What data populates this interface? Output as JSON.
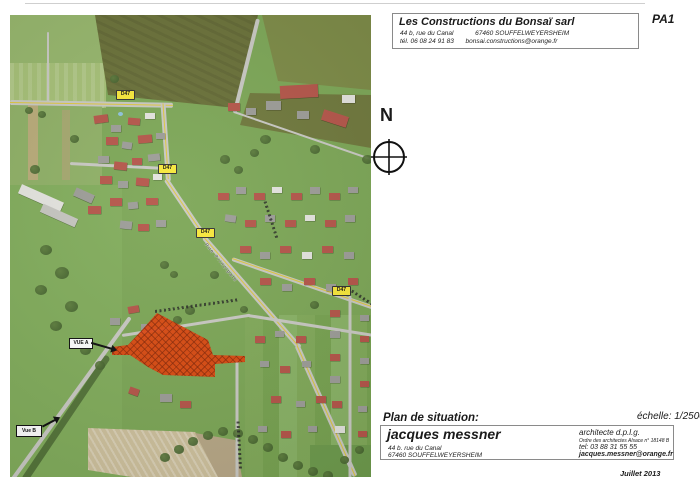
{
  "header": {
    "company_name": "Les Constructions du Bonsaï sarl",
    "company_address": "44 b, rue du Canal",
    "company_city": "67460 SOUFFELWEYERSHEIM",
    "company_phone": "tél. 06 08 24 91 83",
    "company_email": "bonsai.constructions@orange.fr",
    "doc_code": "PA1"
  },
  "compass": {
    "north_label": "N"
  },
  "map": {
    "badges": [
      {
        "label": "D47"
      },
      {
        "label": "D47"
      },
      {
        "label": "D47"
      },
      {
        "label": "D47"
      }
    ],
    "view_a_label": "VUE A",
    "view_b_label": "Vue B",
    "street_label": "Rue Principale",
    "plot_fill": "#e0450e"
  },
  "titleblock": {
    "title": "Plan de situation:",
    "scale": "échelle: 1/2500",
    "architect_name": "jacques messner",
    "architect_address": "44 b. rue du Canal",
    "architect_city": "67460 SOUFFELWEYERSHEIM",
    "architect_title": "architecte d.p.l.g.",
    "architect_ordre": "Ordre des architectes Alsace n° 18148 B",
    "architect_tel": "tel: 03 88 31 55 55",
    "architect_email": "jacques.messner@orange.fr",
    "date": "Juillet 2013"
  }
}
